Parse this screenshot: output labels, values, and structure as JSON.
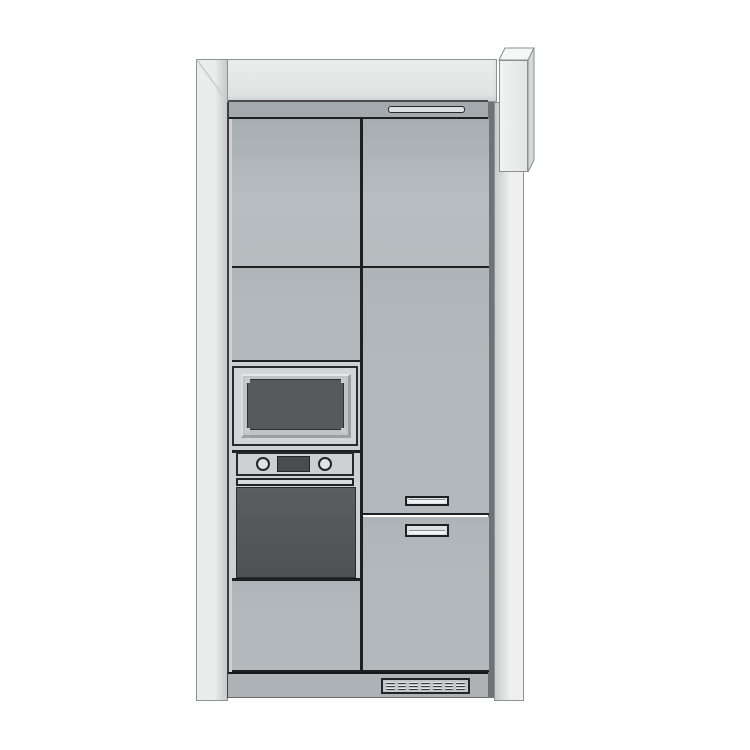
{
  "scene": {
    "kind": "3d-elevation-render",
    "subject": "tall-kitchen-cabinet-unit",
    "background": "#ffffff",
    "components": [
      "frame-cornice",
      "frame-left-stile",
      "frame-right-stile",
      "side-pillar",
      "cabinet-top-rail",
      "top-rail-handle",
      "upper-left-door",
      "mid-left-panel",
      "built-in-microwave",
      "oven-control-panel",
      "oven-knob-left",
      "oven-knob-right",
      "oven-display",
      "oven-handle",
      "oven-door",
      "lower-left-panel",
      "upper-right-door",
      "fridge-door",
      "freezer-door",
      "drawer-handle-upper",
      "drawer-handle-lower",
      "plinth",
      "vent-grille"
    ],
    "vent_grille": {
      "columns": 7,
      "rows": 3
    }
  },
  "palette": {
    "bg": "#ffffff",
    "frame-white": "#ebecec",
    "frame-shade": "#c7c9ca",
    "band-border": "#8f9294",
    "pillar-top": "#f5f6f6",
    "pillar-side": "#d5d7d8",
    "rail-gray": "#a3a9ad",
    "door-dark": "#a7aeb2",
    "door-gray": "#b7bdc0",
    "panel-gray": "#b2b8bb",
    "section-light": "#ced1d2",
    "appliance-frame": "#d3d5d6",
    "bezel-gray": "#bfc3c4",
    "window-dark": "#58595a",
    "display-dark": "#494b4c",
    "oven-dark": "#545657",
    "handle-fill": "#dddfe0",
    "line-dark": "#1e1f20",
    "shadow-strip": "#707375",
    "plinth-gray": "#acb2b5",
    "slat-dark": "#37393b",
    "slat-light": "#e8e9e9"
  }
}
